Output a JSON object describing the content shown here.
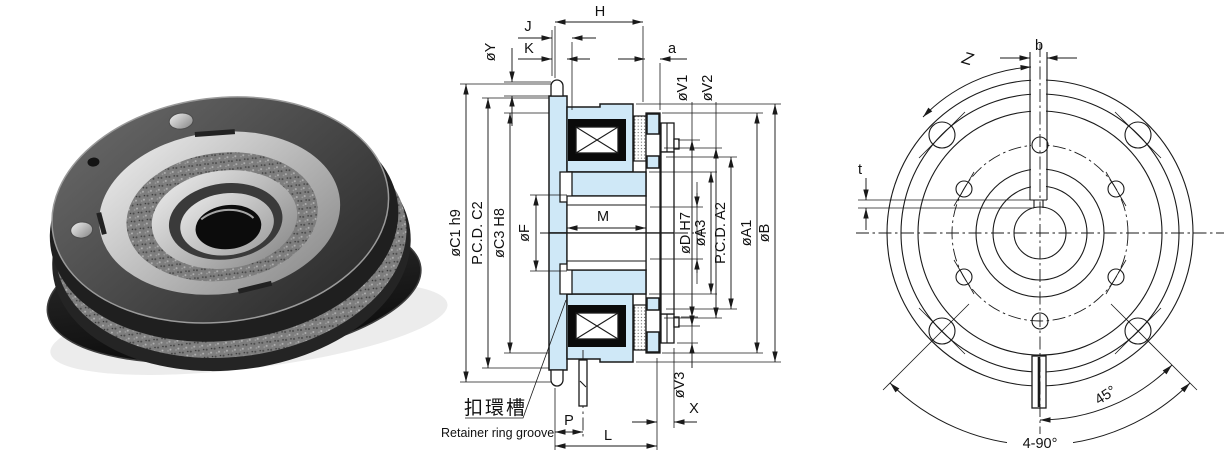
{
  "title": "Electromagnetic clutch dimensional drawing",
  "photo": {
    "subject": "electromagnetic-clutch-product-photo"
  },
  "section": {
    "dims": {
      "H": "H",
      "J": "J",
      "K": "K",
      "Y": "øY",
      "a": "a",
      "C1": "øC1 h9",
      "C2": "P.C.D. C2",
      "C3": "øC3 H8",
      "F": "øF",
      "M": "M",
      "V1": "øV1",
      "V2": "øV2",
      "V3": "øV3",
      "D": "øD H7",
      "A3": "øA3",
      "A2": "P.C.D. A2",
      "A1": "øA1",
      "B": "øB",
      "X": "X",
      "P": "P",
      "L": "L"
    },
    "callout": {
      "zh": "扣環槽",
      "en": "Retainer ring groove"
    }
  },
  "front": {
    "dims": {
      "b": "b",
      "Z": "Z",
      "t": "t",
      "angle45": "45°",
      "angle490": "4-90°"
    }
  },
  "style": {
    "part_fill": "#cfe8f7",
    "line_color": "#1a1a1a",
    "background": "#ffffff"
  }
}
